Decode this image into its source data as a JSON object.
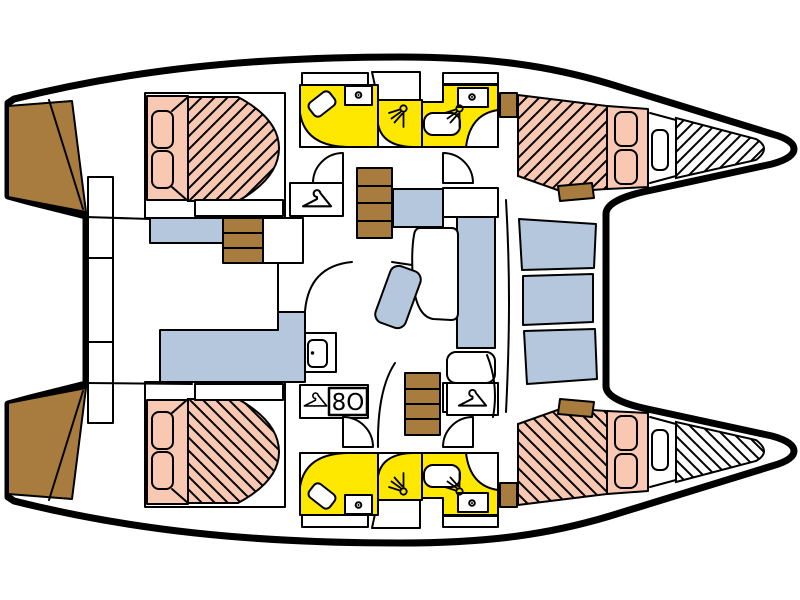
{
  "diagram": {
    "type": "catamaran-interior-floorplan",
    "orientation": "bow-right-stern-left",
    "labels": {
      "appliance": "8O"
    }
  },
  "colors": {
    "outline": "#000000",
    "background": "#ffffff",
    "interior": "#ffffff",
    "wood": "#a87c3e",
    "bed": "#f8c8b2",
    "wet_area": "#ffe800",
    "upholstery": "#b4c7dd"
  },
  "icons": {
    "hanger": "clothes-hanger",
    "shower": "shower-head",
    "sink": "sink-with-faucet",
    "fridge": "fridge-door",
    "appliance": "8O"
  }
}
